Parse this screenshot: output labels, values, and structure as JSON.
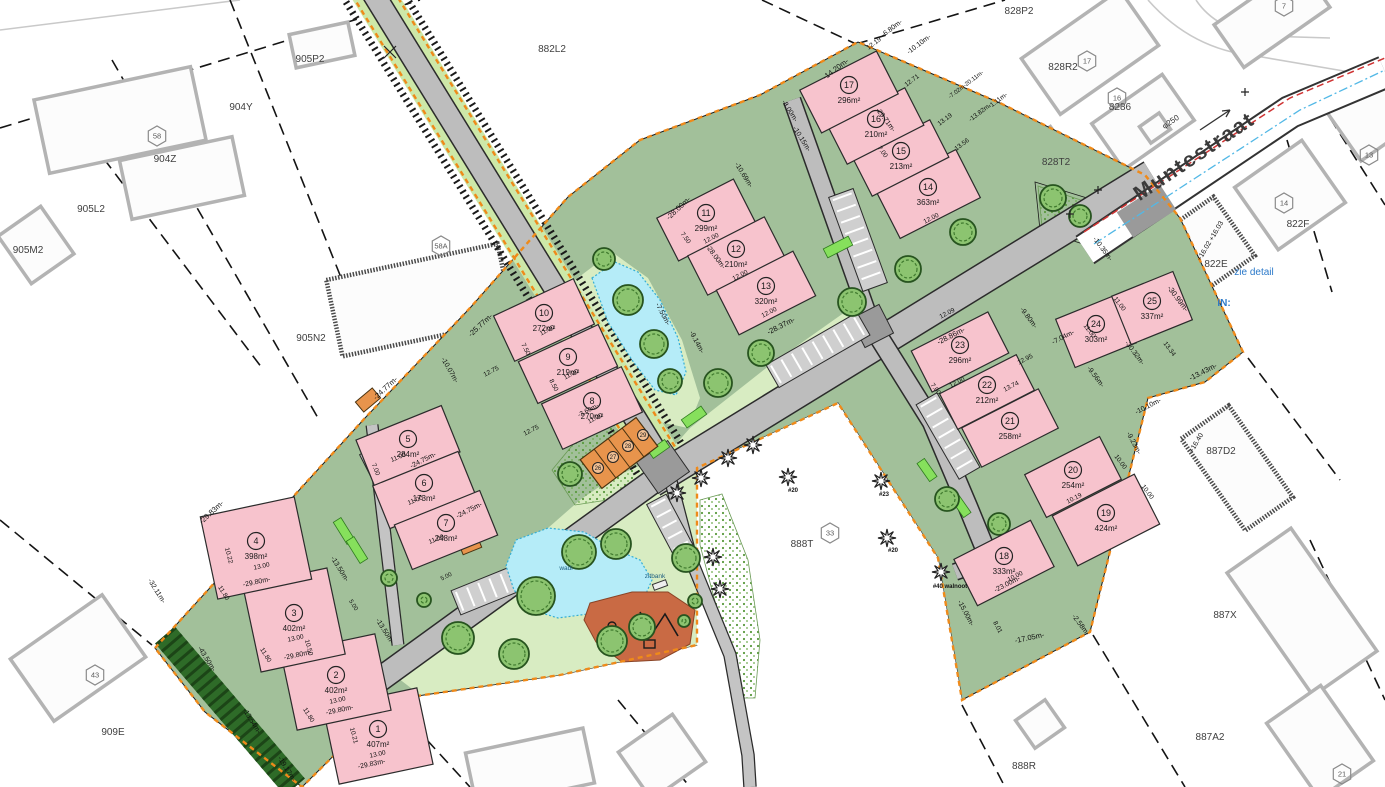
{
  "texts": {
    "street_name": "Muntestraat",
    "pipe_diameter": "φ250",
    "see_detail_note": "zie detail",
    "in_note": "IN:",
    "bench_label": "zitbank",
    "wadi_label": "wadi"
  },
  "colors": {
    "site_green": "#a2c09a",
    "park_green": "#d8ecc2",
    "lot_pink": "#f7c3cd",
    "boundary_orange": "#ef8a1a",
    "water_blue": "#b5ecf8",
    "playground_terracotta": "#c96a44",
    "garage_orange": "#e8944c",
    "hedge_green": "#2e6b28",
    "road_gray": "#bdbdbd",
    "note_blue": "#2b79c9",
    "pipe_red": "#cf3333",
    "pipe_blue": "#52b8e6"
  },
  "lots": [
    {
      "no": "1",
      "area": "407m²",
      "x": 378,
      "y": 736,
      "w": 96,
      "h": 78,
      "r": -12
    },
    {
      "no": "2",
      "area": "402m²",
      "x": 336,
      "y": 682,
      "w": 96,
      "h": 78,
      "r": -12
    },
    {
      "no": "3",
      "area": "402m²",
      "x": 294,
      "y": 620,
      "w": 86,
      "h": 88,
      "r": -12
    },
    {
      "no": "4",
      "area": "398m²",
      "x": 256,
      "y": 548,
      "w": 96,
      "h": 84,
      "r": -12
    },
    {
      "no": "5",
      "area": "284m²",
      "x": 408,
      "y": 446,
      "w": 92,
      "h": 50,
      "r": -22
    },
    {
      "no": "6",
      "area": "173m²",
      "x": 424,
      "y": 490,
      "w": 92,
      "h": 46,
      "r": -22
    },
    {
      "no": "7",
      "area": "248m²",
      "x": 446,
      "y": 530,
      "w": 92,
      "h": 48,
      "r": -22
    },
    {
      "no": "8",
      "area": "270m²",
      "x": 592,
      "y": 408,
      "w": 88,
      "h": 50,
      "r": -25
    },
    {
      "no": "9",
      "area": "219m²",
      "x": 568,
      "y": 364,
      "w": 88,
      "h": 46,
      "r": -25
    },
    {
      "no": "10",
      "area": "272m²",
      "x": 544,
      "y": 320,
      "w": 88,
      "h": 50,
      "r": -25
    },
    {
      "no": "11",
      "area": "299m²",
      "x": 706,
      "y": 220,
      "w": 86,
      "h": 48,
      "r": -27
    },
    {
      "no": "12",
      "area": "210m²",
      "x": 736,
      "y": 256,
      "w": 86,
      "h": 44,
      "r": -27
    },
    {
      "no": "13",
      "area": "320m²",
      "x": 766,
      "y": 293,
      "w": 86,
      "h": 50,
      "r": -27
    },
    {
      "no": "14",
      "area": "363m²",
      "x": 928,
      "y": 194,
      "w": 90,
      "h": 54,
      "r": -27
    },
    {
      "no": "15",
      "area": "213m²",
      "x": 901,
      "y": 158,
      "w": 86,
      "h": 42,
      "r": -27
    },
    {
      "no": "16",
      "area": "210m²",
      "x": 876,
      "y": 126,
      "w": 86,
      "h": 42,
      "r": -27
    },
    {
      "no": "17",
      "area": "296m²",
      "x": 849,
      "y": 92,
      "w": 86,
      "h": 48,
      "r": -27
    },
    {
      "no": "18",
      "area": "333m²",
      "x": 1004,
      "y": 563,
      "w": 86,
      "h": 52,
      "r": -27
    },
    {
      "no": "19",
      "area": "424m²",
      "x": 1106,
      "y": 520,
      "w": 92,
      "h": 56,
      "r": -27
    },
    {
      "no": "20",
      "area": "254m²",
      "x": 1073,
      "y": 477,
      "w": 84,
      "h": 48,
      "r": -27
    },
    {
      "no": "21",
      "area": "258m²",
      "x": 1010,
      "y": 428,
      "w": 86,
      "h": 44,
      "r": -27
    },
    {
      "no": "22",
      "area": "212m²",
      "x": 987,
      "y": 392,
      "w": 86,
      "h": 40,
      "r": -27
    },
    {
      "no": "23",
      "area": "296m²",
      "x": 960,
      "y": 352,
      "w": 86,
      "h": 46,
      "r": -27
    },
    {
      "no": "24",
      "area": "303m²",
      "x": 1096,
      "y": 331,
      "w": 66,
      "h": 52,
      "r": -22
    },
    {
      "no": "25",
      "area": "337m²",
      "x": 1152,
      "y": 308,
      "w": 66,
      "h": 52,
      "r": -22
    }
  ],
  "garages": [
    {
      "no": "26",
      "x": 598,
      "y": 468
    },
    {
      "no": "27",
      "x": 613,
      "y": 457
    },
    {
      "no": "28",
      "x": 628,
      "y": 446
    },
    {
      "no": "29",
      "x": 643,
      "y": 435
    }
  ],
  "parcels": [
    {
      "label": "905P2",
      "x": 310,
      "y": 62
    },
    {
      "label": "904Y",
      "x": 241,
      "y": 110
    },
    {
      "label": "904Z",
      "x": 165,
      "y": 162
    },
    {
      "label": "905L2",
      "x": 91,
      "y": 212
    },
    {
      "label": "905M2",
      "x": 28,
      "y": 253
    },
    {
      "label": "905N2",
      "x": 311,
      "y": 341
    },
    {
      "label": "882L2",
      "x": 552,
      "y": 52
    },
    {
      "label": "828P2",
      "x": 1019,
      "y": 14
    },
    {
      "label": "828R2",
      "x": 1063,
      "y": 70
    },
    {
      "label": "8286",
      "x": 1120,
      "y": 110
    },
    {
      "label": "828T2",
      "x": 1056,
      "y": 165
    },
    {
      "label": "822E",
      "x": 1216,
      "y": 267
    },
    {
      "label": "822F",
      "x": 1298,
      "y": 227
    },
    {
      "label": "887D2",
      "x": 1221,
      "y": 454
    },
    {
      "label": "887X",
      "x": 1225,
      "y": 618
    },
    {
      "label": "887A2",
      "x": 1210,
      "y": 740
    },
    {
      "label": "888R",
      "x": 1024,
      "y": 769
    },
    {
      "label": "888T",
      "x": 802,
      "y": 547
    },
    {
      "label": "909E",
      "x": 113,
      "y": 735
    }
  ],
  "hexagons": [
    {
      "no": "58",
      "x": 157,
      "y": 136
    },
    {
      "no": "58A",
      "x": 441,
      "y": 246
    },
    {
      "no": "33",
      "x": 830,
      "y": 533
    },
    {
      "no": "43",
      "x": 95,
      "y": 675
    },
    {
      "no": "21",
      "x": 1342,
      "y": 774
    },
    {
      "no": "13",
      "x": 1369,
      "y": 155
    },
    {
      "no": "14",
      "x": 1284,
      "y": 203
    },
    {
      "no": "16",
      "x": 1117,
      "y": 98
    },
    {
      "no": "17",
      "x": 1087,
      "y": 61
    },
    {
      "no": "7",
      "x": 1284,
      "y": 6
    }
  ],
  "elevations": [
    {
      "t": "+16.03",
      "x": 1218,
      "y": 232
    },
    {
      "t": "+16.02",
      "x": 1206,
      "y": 252
    },
    {
      "t": "+16.40",
      "x": 1198,
      "y": 444
    }
  ],
  "star_labels": [
    {
      "t": "#20",
      "x": 793,
      "y": 492
    },
    {
      "t": "#23",
      "x": 884,
      "y": 496
    },
    {
      "t": "#20",
      "x": 893,
      "y": 552
    },
    {
      "t": "#40 walnoot",
      "x": 950,
      "y": 588
    }
  ],
  "dims": [
    [
      "-29.83m-",
      213,
      514,
      -43,
      7.5
    ],
    [
      "-24.77m-",
      387,
      390,
      -43,
      7.5
    ],
    [
      "-25.77m-",
      482,
      327,
      -43,
      7.5
    ],
    [
      "-28.00m-",
      680,
      210,
      -43,
      7.5
    ],
    [
      "-14.20m-",
      837,
      71,
      -37,
      7.5
    ],
    [
      "12.19",
      875,
      45,
      -37,
      6.5
    ],
    [
      "-6.80m-",
      893,
      30,
      -37,
      7
    ],
    [
      "-10.10m-",
      920,
      46,
      -37,
      7
    ],
    [
      "12.71",
      913,
      82,
      -37,
      6.5
    ],
    [
      "-7.02m-20.11m-",
      967,
      86,
      -37,
      6
    ],
    [
      "13.19",
      946,
      121,
      -37,
      6.5
    ],
    [
      "-13.82m-",
      981,
      114,
      -37,
      6.5
    ],
    [
      "-1.11m-",
      999,
      102,
      -37,
      6.5
    ],
    [
      "13.56",
      963,
      146,
      -37,
      6.5
    ],
    [
      "-10.69m-",
      742,
      176,
      58,
      7
    ],
    [
      "-8.00m-",
      788,
      112,
      58,
      7
    ],
    [
      "-10.15m-",
      800,
      140,
      58,
      7
    ],
    [
      "-29.71m-",
      884,
      121,
      53,
      7
    ],
    [
      "-28.00m-",
      714,
      258,
      53,
      7
    ],
    [
      "-28.37m-",
      782,
      328,
      -27,
      7.5
    ],
    [
      "-28.86m-",
      952,
      338,
      -27,
      7.5
    ],
    [
      "-9.14m-",
      695,
      343,
      62,
      7
    ],
    [
      "-7.50m-",
      661,
      315,
      62,
      7
    ],
    [
      "-10.07m-",
      448,
      371,
      60,
      7
    ],
    [
      "12.75",
      492,
      373,
      -27,
      6.5
    ],
    [
      "12.75",
      532,
      432,
      -27,
      6.5
    ],
    [
      "-24.75m-",
      424,
      462,
      -27,
      7
    ],
    [
      "-24.75m-",
      470,
      512,
      -27,
      7
    ],
    [
      "-13.50m-",
      338,
      570,
      58,
      7
    ],
    [
      "-13.50m-",
      383,
      632,
      58,
      7
    ],
    [
      "-29.80m-",
      257,
      584,
      -12,
      7
    ],
    [
      "-29.80m-",
      298,
      657,
      -12,
      7
    ],
    [
      "-29.80m-",
      340,
      712,
      -12,
      7
    ],
    [
      "-29.83m-",
      372,
      766,
      -12,
      7
    ],
    [
      "-32.11m-",
      155,
      592,
      58,
      7
    ],
    [
      "-43.50m-",
      205,
      660,
      58,
      7
    ],
    [
      "-13.54m-",
      250,
      722,
      58,
      7
    ],
    [
      "-19.17m-",
      285,
      770,
      58,
      7
    ],
    [
      "11.80",
      222,
      594,
      58,
      6.5
    ],
    [
      "11.80",
      264,
      656,
      58,
      6.5
    ],
    [
      "11.80",
      307,
      716,
      58,
      6.5
    ],
    [
      "13.00",
      378,
      756,
      -12,
      6.5
    ],
    [
      "13.00",
      338,
      702,
      -12,
      6.5
    ],
    [
      "13.00",
      296,
      640,
      -12,
      6.5
    ],
    [
      "13.00",
      262,
      568,
      -12,
      6.5
    ],
    [
      "10.21",
      352,
      736,
      75,
      6.5
    ],
    [
      "10.50",
      307,
      648,
      75,
      6.5
    ],
    [
      "10.22",
      227,
      556,
      75,
      6.5
    ],
    [
      "11.00",
      399,
      459,
      -22,
      6.5
    ],
    [
      "11.00",
      416,
      502,
      -22,
      6.5
    ],
    [
      "11.00",
      437,
      541,
      -22,
      6.5
    ],
    [
      "7.00",
      374,
      470,
      68,
      6.5
    ],
    [
      "11.00",
      596,
      420,
      -27,
      6.5
    ],
    [
      "11.00",
      572,
      376,
      -27,
      6.5
    ],
    [
      "11.00",
      548,
      332,
      -27,
      6.5
    ],
    [
      "7.50",
      524,
      350,
      63,
      6.5
    ],
    [
      "8.50",
      552,
      386,
      63,
      6.5
    ],
    [
      "12.00",
      712,
      240,
      -27,
      6.5
    ],
    [
      "12.00",
      741,
      277,
      -27,
      6.5
    ],
    [
      "12.00",
      770,
      314,
      -27,
      6.5
    ],
    [
      "7.50",
      684,
      239,
      53,
      6.5
    ],
    [
      "12.00",
      932,
      220,
      -27,
      6.5
    ],
    [
      "7.00",
      881,
      153,
      53,
      6.5
    ],
    [
      "-30.99m-",
      1176,
      300,
      53,
      7.5
    ],
    [
      "-30.32m-",
      1133,
      354,
      53,
      7
    ],
    [
      "-13.43m-",
      1204,
      374,
      -27,
      7.5
    ],
    [
      "-10.10m-",
      1149,
      408,
      -27,
      7
    ],
    [
      "-10.35m-",
      1101,
      250,
      53,
      7
    ],
    [
      "-9.23m-",
      1132,
      444,
      62,
      7
    ],
    [
      "-9.56m-",
      1094,
      378,
      53,
      7
    ],
    [
      "-9.80m-",
      1027,
      319,
      53,
      7
    ],
    [
      "-7.04m-",
      1064,
      339,
      -27,
      7
    ],
    [
      "12.09",
      948,
      315,
      -27,
      6.5
    ],
    [
      "12.95",
      1026,
      361,
      -27,
      6.5
    ],
    [
      "13.74",
      1012,
      388,
      -27,
      6.5
    ],
    [
      "13.34",
      1168,
      350,
      53,
      6.5
    ],
    [
      "11.00",
      1118,
      305,
      53,
      6.5
    ],
    [
      "11.00",
      1088,
      332,
      53,
      6.5
    ],
    [
      "12.00",
      958,
      384,
      -27,
      6.5
    ],
    [
      "7.00",
      934,
      390,
      53,
      6.5
    ],
    [
      "-15.00m-",
      964,
      614,
      62,
      7
    ],
    [
      "-17.05m-",
      1030,
      640,
      -12,
      7.5
    ],
    [
      "-2.58m-",
      1079,
      626,
      53,
      7
    ],
    [
      "-23.00m-",
      1008,
      586,
      -27,
      7
    ],
    [
      "10.00",
      1119,
      463,
      53,
      6.5
    ],
    [
      "10.00",
      1146,
      493,
      53,
      6.5
    ],
    [
      "10.19",
      1075,
      500,
      -27,
      6.5
    ],
    [
      "8.01",
      996,
      628,
      62,
      6.5
    ],
    [
      "10.00",
      1016,
      578,
      -27,
      6.5
    ],
    [
      "-3.60m-",
      589,
      412,
      -27,
      6.5
    ],
    [
      "5.00",
      447,
      578,
      -27,
      6
    ],
    [
      "5.00",
      352,
      606,
      58,
      6
    ]
  ]
}
